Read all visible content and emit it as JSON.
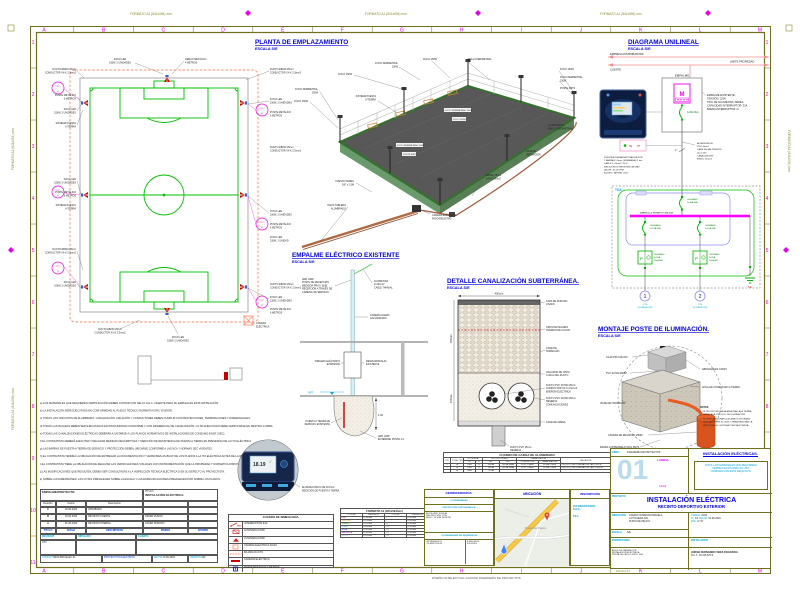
{
  "sheet": {
    "format_label": "FORMATO A1 (841x594) mm",
    "print_label": "ESCALA A3",
    "footer": "DISEÑO INTELECTUAL GALVANI INGENIERÍA DE PROYECTOS",
    "grid_letters": [
      "A",
      "B",
      "C",
      "D",
      "E",
      "F",
      "G",
      "H",
      "I",
      "J",
      "K",
      "L",
      "M"
    ],
    "grid_numbers": [
      "1",
      "2",
      "3",
      "4",
      "5",
      "6",
      "7",
      "8",
      "9",
      "10",
      "11"
    ],
    "colors": {
      "olive": "#6f6f1f",
      "magenta": "#e800e8",
      "blue": "#0000d8",
      "cyan": "#00a6d8",
      "green": "#00b400",
      "red": "#cc0000",
      "duct_orange": "#ff8a65"
    }
  },
  "planta": {
    "title": "PLANTA DE EMPLAZAMIENTO",
    "scale": "ESCALA S/E",
    "cto": "CTO",
    "c1": "1",
    "c2": "2",
    "ll": {
      "ducto": [
        "DUCTO EB040 25mm",
        "CONDUCTOR XX-K 2.5mm2"
      ],
      "foco2": [
        "FOCO LED",
        "150W, 2 UNIDADES"
      ],
      "foco1": [
        "FOCO LED",
        "150W, 1 UNIDAD"
      ],
      "poste": [
        "POSTE METÁLICO",
        "6 METROS"
      ],
      "spat": [
        "SISTEMA PUESTA",
        "A TIERRA"
      ],
      "camara": [
        "CÁMARA",
        "ELÉCTRICA"
      ],
      "cerco": [
        "CERCO METÁLICO",
        "4 METROS"
      ]
    }
  },
  "iso": {
    "foco": "FOCO 150W",
    "foco_per": [
      "FOCO PERIMETRAL",
      "150W"
    ],
    "foco_per_1l": "FOCO PERIMETRAL 150W",
    "poste": "POSTE 6MTS",
    "malla": "MALLA PERIMETRAL",
    "spat": [
      "SISTEMA PUESTA",
      "A TIERRA"
    ],
    "pletina": [
      "CAJA PLETINA",
      "(MALLA PERIMETRAL)"
    ],
    "deriv": [
      "CAJA DE",
      "DERIVACIÓN"
    ],
    "ducto": [
      "EB040, 25mm",
      "XX-K 2.5mm2"
    ],
    "pt": [
      "PUESTA TIERRA",
      "5/8\" x 1.5M"
    ],
    "hacia": [
      "HACIA TABLERO",
      "ALUMBRADO"
    ],
    "camara": [
      "CÁMARA ELÉCTRICA",
      "PASO/REGISTRO"
    ]
  },
  "unilineal": {
    "title": "DIAGRAMA UNILINEAL",
    "scale": "ESCALA S/E",
    "empresa": "EMPRESA DISTRIBUIDORA",
    "cliente": "CLIENTE",
    "limite": "LIMITE PROPIEDAD",
    "empalme": "EMPALME",
    "medidor": "M",
    "main_breaker": "1x32A 6kA",
    "empalme_info": [
      "EMPALME EXISTENTE:",
      "TENSIÓN: 220V",
      "TIPO DE ACOMETIDA: AÉREA",
      "CAPACIDAD INTERRUPTOR: 32A",
      "BARRA INTERRUPTOR: D"
    ],
    "tetp": {
      "te": "TE",
      "tp": "TP"
    },
    "spat_info": [
      "PUESTA A TIERRA NEUTRALIZACIÓN",
      "2 BARRAS 1.5mts, SEPARADAS 2 mts",
      "CABLE 2 x 6mm2, XX-K",
      "MEDICIÓN DE RESISTENCIA SPAT",
      "VALOR: 18.19 OHM",
      "EQUIPO: METREL 2100"
    ],
    "n2": "2",
    "alim_info": [
      "ALIMENTADOR:",
      "XX-K 6mm2",
      "LIBRE DE HALÓGENOS",
      "Vp=0.24V",
      "CANALIZACIÓN:",
      "EB040, 25mm2"
    ],
    "tda": "TDA",
    "ta": "T.A.",
    "int_general": [
      "LEGRAND",
      "2x40A 6kA"
    ],
    "barra": "BARRA (Cu) REPARTIDORA 80A",
    "int_circ": [
      "LEGRAND",
      "1x10A 6kA"
    ],
    "dif": [
      "LEGRAND",
      "2x25A",
      "30mA AC"
    ],
    "difsym": "P",
    "c1": "1",
    "c2": "2",
    "cte": [
      "CTE",
      "ILUMINACIÓN"
    ]
  },
  "empalme_det": {
    "title": "EMPALME ELÉCTRICO EXISTENTE",
    "scale": "ESCALA S/E",
    "arr": [
      "ARR. EMP.",
      "POSTE DE RECEPCIÓN",
      "MEDIDOR PROV. [S/E]",
      "RECEPCIÓN A TRAVÉS DE",
      "CABEZAL DE SERVICIO"
    ],
    "acometida": [
      "ACOMETIDA",
      "2x10mm2",
      "CABLE THHN/AL"
    ],
    "caneria": [
      "CAÑERÍA ACERO",
      "GALVANIZADO"
    ],
    "tablero": [
      "TABLERO ELÉCTRICO",
      "EXISTENTE"
    ],
    "desviador": [
      "DESVIADOR/ALZA",
      "EXISTENTE"
    ],
    "npt": "NPT",
    "spat": [
      "PUESTA A TIERRA DE",
      "SERVICIO EXISTENTE"
    ],
    "enterrar": [
      "ARR. EMP.",
      "ENTERRAR POSTE 1.0"
    ],
    "dim": "1.00"
  },
  "canalizacion": {
    "title": "DETALLE CANALIZACIÓN SUBTERRÁNEA.",
    "scale": "ESCALA S/E",
    "dim_w": "400mm",
    "dim_h1": "450mm",
    "dim_h2": "150mm",
    "l_rodado": [
      "CAPA DE RODADO",
      "LISADO"
    ],
    "l_cinta": [
      "CINTA DE PELIGRO",
      "TENDIDO DE COLOR"
    ],
    "l_cama": [
      "CAMA DE",
      "HORMIGÓN"
    ],
    "l_aislador": [
      "AISLADOR DE CINTA",
      "A 40cm DEL DUCTO"
    ],
    "l_ducto1": [
      "DUCTO PVC SCH40 25mm",
      "CONDUCTOR XX-K 2.5mm2",
      "ENERGÍA ELÉCTRICA"
    ],
    "l_ducto2": [
      "DUCTO PVC SCH40 25mm",
      "RESERVA",
      "COMUNICACIONES"
    ],
    "l_arena": "CAMA DE ARENA",
    "l_reserva": [
      "DUCTO PVC 25mm",
      "RESERVA"
    ]
  },
  "montaje": {
    "title": "MONTAJE POSTE DE ILUMINACIÓN.",
    "scale": "ESCALA S/E",
    "caja": "CAJA IP65 100x100",
    "pvc": "PVC SCH40 25MM",
    "abrazadera": "ABRAZADERA CADDY",
    "anclaje": "ANCLAJE CONECTADO A TIERRA",
    "base": "BASE DE HORMIGÓN",
    "camara": "CÁMARA DE REGISTRO 25MM",
    "barra": "BARRA COPPERWELD 5/8x1.5MTS",
    "notas_title": "NOTAS:",
    "notas": [
      "1. SE PROYECTA UNA BAJADA (MALLA) A TIERRA",
      "PARA CADA CIRCUITO DE ILUMINACIÓN.",
      "2. SE DEBE ASEGURAR QUE AMBOS SISTEMAS",
      "DESCANSEN EN EL SUELO PARA REALIZAR LA",
      "MEDICIÓN DEL SISTEMA PUESTA A TIERRA."
    ]
  },
  "apuntes": [
    "a) LOS MATERIALES QUE REQUIEREN CERTIFICACIÓN DEBEN CONTAR CON SELLO S.E.C. VIGENTE PARA SU EMPLEO EN ESTA INSTALACIÓN.",
    "b) LA INSTALACIÓN SERÁ EJECUTADA EN CONFORMIDAD AL PLIEGO TÉCNICO NORMATIVO RIC VIGENTE.",
    "c) TODOS LOS CIRCUITOS DE ALUMBRADO, CANALIZACIÓN, AISLACIÓN Y CONDUCTORES DEBEN CUMPLIR CON PROTECCIONES, TERMINACIONES Y DIFERENCIALES.",
    "d) TODAS LAS BAJADAS DEBEN SER EJECUTADAS EN PROFUNDIDAD CONFORME Y CON DIFERENCIAL DE CANALIZACIÓN; LO NO EJECUTADO DEBE VERIFICARSE EN DESTINO A OBRA.",
    "e) TODAS LAS CANALIZACIONES ELÉCTRICAS DEBERÁN AJUSTARSE A LOS PLANOS NORMATIVOS DE INSTALACIONES DE CONSUMO EN BT (SEC).",
    "f) EL CONTRATISTA DEBERÁ EJECUTAR Y REALIZAR MEDIDAS DESCRIPTIVAS Y MEDICIÓN DE RESISTENCIA DE PUESTA A TIERRA EN PRESENCIA DE LA ITO ELÉCTRICA.",
    "g) LAS BARRAS DE PUESTA A TIERRA DE SERVICIO Y PROTECCIÓN DEBEN UBICARSE CONFORME A LAS NCh Y NORMAS SEC VIGENTES.",
    "h) EL CONTRATISTA TENDRÁ LA OBLIGACIÓN DE ENTREGAR LA DOCUMENTACIÓN Y VERSIONES AS-BUILT DE LOS PLANOS A LA ITO ELÉCTRICA ANTES DE LA RECEPCIÓN SEC.",
    "i) EL CONTRATISTA TIENE LA OBLIGACIÓN DE REALIZAR LAS VERIFICACIONES VISUALES CON INSTRUMENTACIÓN QUE LA PROPIEDAD Y NORMATIVA DISPONGAN Y SUGIERAN.",
    "j) LAS MODIFICACIONES QUE RESULTEN, DEBEN SER CONSULTADAS A LA INSPECCIÓN TÉCNICA ELÉCTRICA O EN SU DEFECTO AL PROYECTISTA.",
    "k) SOBRE LAS DIMENSIONES: LAS COTAS PREVALECEN SOBRE LA ESCALA Y LAS ESPECIFICACIONES PREVALECEN POR SOBRE LOS PLANOS."
  ],
  "medicion": {
    "valor": "18.19",
    "check": "✓",
    "nota": [
      "EL RESULTADO FUE 18.19 Ω,",
      "MEDICIÓN DE PUESTA A TIERRA."
    ]
  },
  "rev_table": {
    "header_left": "EMPALME/PROYECTO:",
    "titulo_label": "TÍTULO:",
    "titulo": "INSTALACIÓN ELÉCTRICA.",
    "cols": [
      "Revisión",
      "Fecha",
      "Descripción"
    ],
    "rows": [
      {
        "rev": "C",
        "fecha": "10-06-2023",
        "desc": "APROBADO.",
        "por": ""
      },
      {
        "rev": "B",
        "fecha": "15-06-2023",
        "desc": "REVISIÓN CLIENTE.",
        "por": "DIDIER MUÑOZ"
      },
      {
        "rev": "A",
        "fecha": "01-06-2023",
        "desc": "REVISIÓN INTERNA.",
        "por": "JAVIER DONOSO"
      }
    ],
    "blue_cols": [
      "TÍTULO",
      "FECHA",
      "DESCRIPCIÓN",
      "DISEÑO",
      "APROBÓ"
    ],
    "rev_label": "REVISIÓN*",
    "dib_label": "DIBUJADO",
    "cliente_label": "CLIENTE:",
    "rev_value": "XXX",
    "codigo_label": "CÓDIGO*",
    "codigo": "B203-PRO-ELEC-01",
    "proyectista": "PROYECTISTA ELÉCTRICO.",
    "fecha_label": "FECHA",
    "fecha": "10-06-2023",
    "version_label": "VERSIÓN",
    "version": "A01"
  },
  "simbologia": {
    "title": "CUADRO DE SIMBOLOGÍA.",
    "items": [
      "INTERRUPTOR 9/12",
      "LUMINARIA 150W",
      "LUMINARIA 150W",
      "CÁMARA ELÉCTRICA 40x40",
      "BAJADA DUCTO",
      "CAÑERÍA ELÉCTRICA",
      "POSTE METÁLICO 7 METROS"
    ]
  },
  "formato_table": {
    "title": "FORMATO A1 (841x594mm)",
    "headers": [
      "COLOR",
      "ESPESOR",
      "COLOR",
      "ESPESOR"
    ],
    "rows": [
      [
        "RED",
        "0.18 mm",
        "8",
        "0.18 mm"
      ],
      [
        "YELLOW",
        "0.25 mm",
        "9",
        "0.18 mm"
      ],
      [
        "GREEN",
        "0.25 mm",
        "30",
        "0.18 mm"
      ],
      [
        "CYAN",
        "0.35 mm",
        "150",
        "0.25 mm"
      ],
      [
        "BLUE",
        "0.50 mm",
        "170",
        "0.18 mm"
      ],
      [
        "MAGENTA",
        "0.18 mm",
        "210",
        "0.18 mm"
      ],
      [
        "WHITE",
        "0.25 mm",
        "250",
        "0.18 mm"
      ]
    ]
  },
  "carga_table": {
    "title": "CUADRO DE CARGA DE ALUMBRADO",
    "h1": [
      "CTO",
      "TOTAL CENTROS",
      "POTENCIA",
      "PROTECCIONES",
      "CANALIZACIÓN",
      "UBICACIÓN"
    ],
    "h2": [
      "W",
      "F",
      "INT.",
      "DIF.",
      "CONDUCTOR",
      "CANALIZACIÓN"
    ],
    "rows": [
      [
        "1",
        "10",
        "1500",
        "R",
        "1x10A",
        "2x25A 30mA",
        "XX-K 2.5mm2",
        "SCH40 25mm",
        "CIRCUITO DE ILUMINACIÓN LADO ESTE"
      ],
      [
        "2",
        "10",
        "1500",
        "S",
        "1x10A",
        "2x25A 30mA",
        "XX-K 2.5mm2",
        "SCH40 25mm",
        "CIRCUITO DE ILUMINACIÓN LADO OESTE"
      ],
      [
        "",
        "20",
        "3000",
        "",
        "TOTAL",
        "",
        "",
        "",
        ""
      ]
    ]
  },
  "georeferencia": {
    "title": "GEOREFERENCIA.",
    "sec1": "COORDENADAS",
    "sec2": "PROYECCIÓN CARTOGRÁFICA",
    "lines": [
      "ELIPSOIDE: WGS-84",
      "PROYECCIÓN: UTM",
      "HUSO: 19 SUR (NORTE)"
    ],
    "sec3": "COORDENADAS DE REFERENCIA",
    "cell1": [
      "-33.59634178 S",
      "-70.69817236 W"
    ],
    "cell2": [
      "6.298.345 N",
      "329.823 E"
    ]
  },
  "ubicacion": {
    "title": "UBICACIÓN",
    "lugar": "Punta de Peuco"
  },
  "inscripcion": {
    "title": "INSCRIPCIÓN",
    "lines": [
      "P/A REGISTRADO",
      "S.E.C.",
      "TE-1"
    ]
  },
  "titulo_bloque": {
    "obra_label": "OBRA",
    "empresa": "INGENIERÍA DE PROYECTOS",
    "lamina_label": "LÁMINA",
    "lamina": "01",
    "formato": "A1/A3",
    "header": "INSTALACIÓN ELÉCTRICAS.",
    "nota": [
      "NOTA: LOS MATERIALES QUE REQUIEREN",
      "CERTIFICACIÓN PARA SU USO,",
      "CUMPLEN CON ESTE REQUISITO."
    ],
    "proyecto_label": "PROYECTO:",
    "proyecto1": "INSTALACIÓN ELÉCTRICA",
    "proyecto2": "RECINTO DEPORTIVO EXTERIOR",
    "direccion_label": "DIRECCIÓN:",
    "direccion": [
      "CAMINO INTERIOR PARCELA",
      "LA HIGUERA S/N,",
      "PUNTA DE PEUCO."
    ],
    "escala_label": "ESCALA:",
    "escala": "S/E",
    "propietario_label": "PROPIETARIO",
    "lamina2_label": "LÁMINA:",
    "lamina2": "01/01",
    "n_label": "Nº:",
    "n": "1/2",
    "fecha_label": "FECHA:",
    "fecha": "01-06-2023",
    "rol_label": "ROL:",
    "rol": "0-717",
    "instalador_label": "INSTALADOR",
    "aviso": [
      "AVISO DE TÉRMINO DE",
      "INSTALACIÓN ELÉCTRICA",
      "PUNTA DE PEUCO PROV. S/N."
    ],
    "nombre": "JORGE FERNANDO VERA FIGUEROA",
    "rut": "R.U.T.: 18.345.678-9"
  },
  "icons": {
    "map_pin": "location-pin",
    "nav_marker": "navigation-marker",
    "check": "checkmark"
  }
}
